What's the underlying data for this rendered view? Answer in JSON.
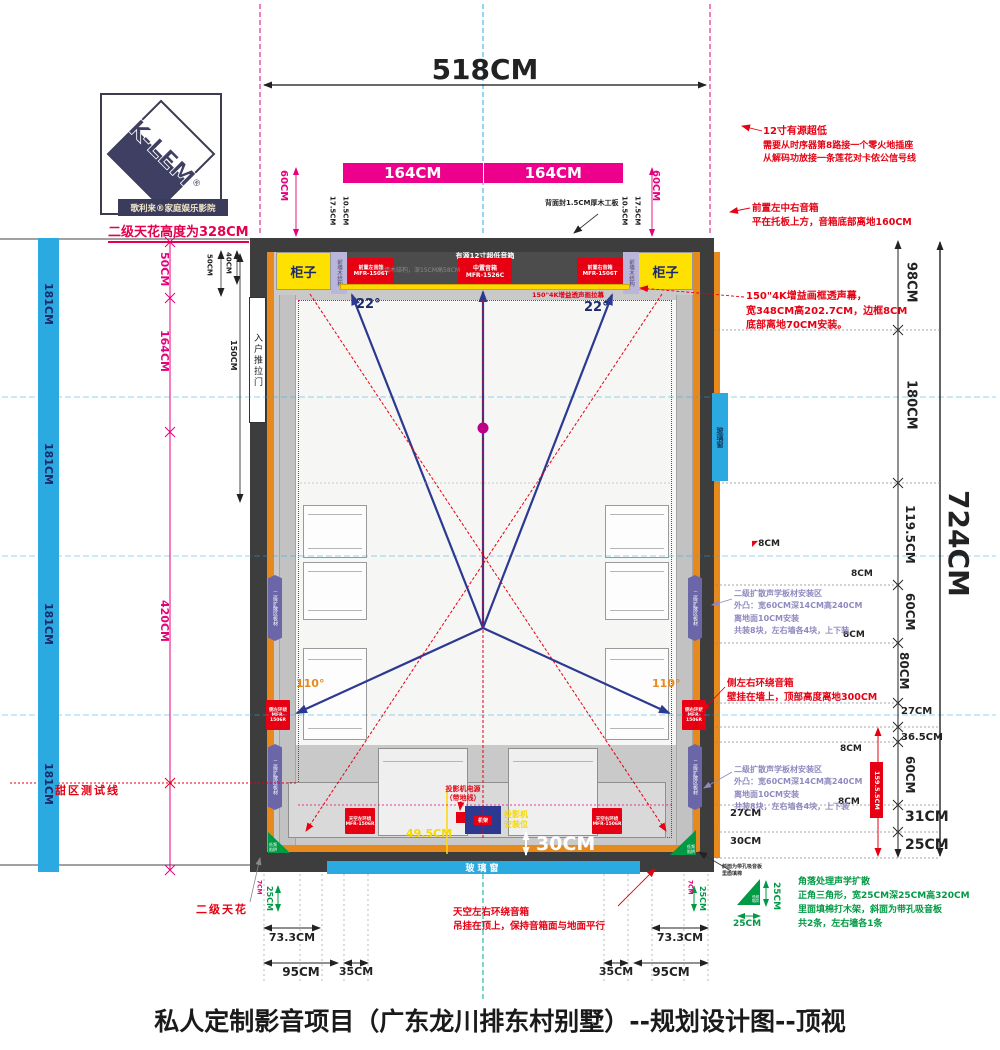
{
  "title": "私人定制影音项目（广东龙川排东村别墅）--规划设计图--顶视",
  "logo": {
    "brand": "K-LEM",
    "reg": "®",
    "subtitle": "歌利来®家庭娱乐影院",
    "note": "二级天花高度为328CM"
  },
  "top": {
    "d518": "518CM",
    "panel_left": "164CM",
    "panel_right": "164CM",
    "back_note": "背面封1.5CM厚木工板"
  },
  "stage": {
    "cabinet_left": "柜子",
    "cabinet_right": "柜子",
    "wood_strip_left": "前墙木结构",
    "wood_strip_right": "前墙木结构",
    "sub_label": "有源12寸超低音箱",
    "wood_note": "前墙木结构，深15CM高58CM",
    "screen_note": "150\"4K增益透声画拉幕",
    "spk_fl": [
      "前置左音箱",
      "MFR-1506T"
    ],
    "spk_c": [
      "中置音箱",
      "MFR-1526C"
    ],
    "spk_fr": [
      "前置右音箱",
      "MFR-1506T"
    ]
  },
  "room": {
    "door": "入户推拉门",
    "window_right": "玻璃窗",
    "window_bottom": "玻璃窗",
    "rack_tag": "机架",
    "diffuser_strip": "二级扩散区板材",
    "side_sp_l": [
      "侧左环绕",
      "MFR-1506R"
    ],
    "side_sp_r": [
      "侧右环绕",
      "MFR-1506R"
    ],
    "sky_sp_l": [
      "天空左环绕",
      "MFR-1506R"
    ],
    "sky_sp_r": [
      "天空右环绕",
      "MFR-1506R"
    ],
    "trap": [
      "低频",
      "陷阱"
    ]
  },
  "angles": {
    "a22l": "22°",
    "a22r": "22°",
    "a110l": "110°",
    "a110r": "110°"
  },
  "annotations": {
    "sub12": [
      "12寸有源超低",
      "需要从时序器第8路接一个零火地插座",
      "从解码功放接一条莲花对卡侬公信号线"
    ],
    "front": [
      "前置左中右音箱",
      "平在托板上方，音箱底部离地160CM"
    ],
    "screen": [
      "150\"4K增益画框透声幕，",
      "宽348CM高202.7CM，边框8CM",
      "底部离地70CM安装。"
    ],
    "diffuser": [
      "二级扩散声学板材安装区",
      "外凸：宽60CM深14CM高240CM",
      "离地面10CM安装",
      "共装8块，左右墙各4块，上下装"
    ],
    "side_surround": [
      "侧左右环绕音箱",
      "壁挂在墙上，顶部高度离地300CM"
    ],
    "sky_surround": [
      "天空左右环绕音箱",
      "吊挂在顶上，保持音箱面与地面平行"
    ],
    "corner": [
      "角落处理声学扩散",
      "正角三角形，宽25CM深25CM高320CM",
      "里面填棉打木架，斜面为带孔吸音板",
      "共2条，左右墙各1条"
    ],
    "corner_small": [
      "斜面为带孔吸音板",
      "里面填棉"
    ],
    "projector_power": [
      "投影机电源",
      "（带地线）"
    ],
    "projector_pos": [
      "投影机",
      "安装位"
    ],
    "sweet": "甜区测试线",
    "ceiling2": "二级天花"
  },
  "dims": {
    "left_bar": [
      "181CM",
      "181CM",
      "181CM",
      "181CM"
    ],
    "l50p": "50CM",
    "l50": "50CM",
    "l40": "40CM",
    "l164": "164CM",
    "l150": "150CM",
    "l420": "420CM",
    "t60l": "60CM",
    "t175l": "17.5CM",
    "t105l": "10.5CM",
    "t105r": "10.5CM",
    "t175r": "17.5CM",
    "t60r": "60CM",
    "r98": "98CM",
    "r180": "180CM",
    "r1195": "119.5CM",
    "r60a": "60CM",
    "r80": "80CM",
    "r27": "27CM",
    "r365": "36.5CM",
    "r60b": "60CM",
    "r31": "31CM",
    "r25": "25CM",
    "r724": "724CM",
    "r1595": "159.5.5CM",
    "r8": [
      "8CM",
      "8CM",
      "8CM",
      "8CM",
      "8CM"
    ],
    "i27": "27CM",
    "i30": "30CM",
    "w30": "30CM",
    "y495": "49.5CM",
    "b733l": "73.3CM",
    "b95l": "95CM",
    "b35l": "35CM",
    "b35r": "35CM",
    "b95r": "95CM",
    "b733r": "73.3CM",
    "b25l": "25CM",
    "b25r": "25CM",
    "b7l": "7CM",
    "b7r": "7CM",
    "c25v": "25CM",
    "c25h": "25CM"
  },
  "colors": {
    "accent_pink": "#EC008C",
    "accent_red": "#E60012",
    "accent_blue": "#2BA9E1",
    "accent_navy": "#2B3990",
    "accent_green": "#009944",
    "accent_yellow": "#FFE100",
    "accent_orange": "#E8891D",
    "wall": "#3D3D3D"
  }
}
